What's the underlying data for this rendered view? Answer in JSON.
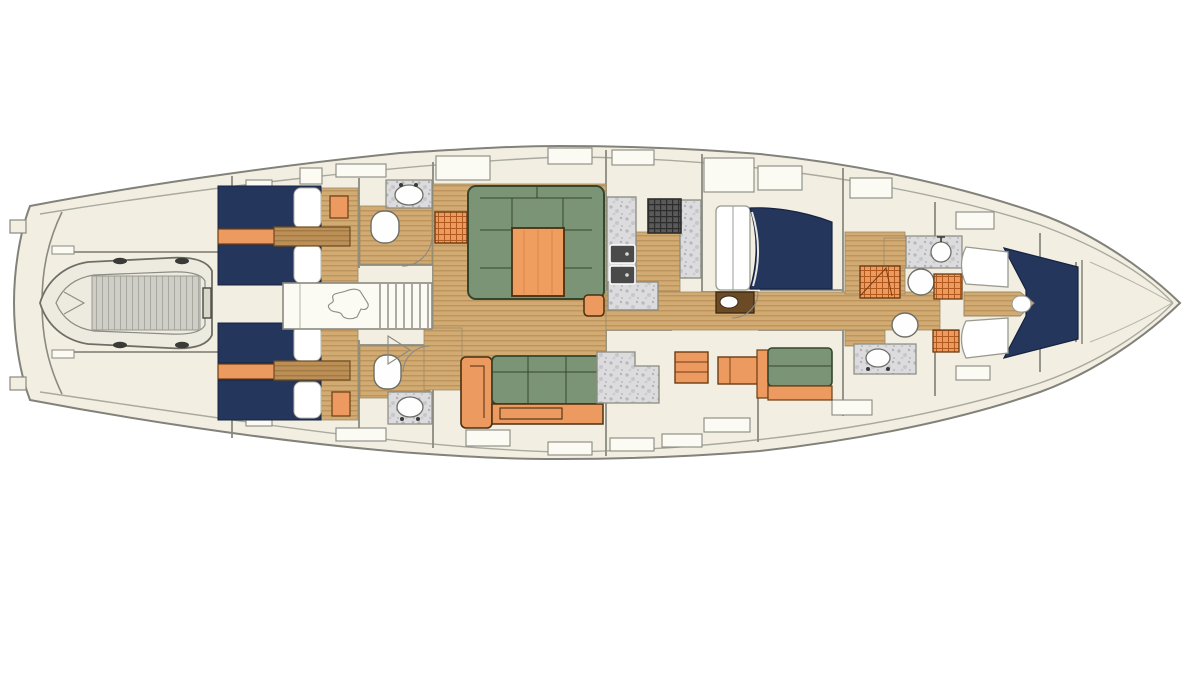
{
  "meta": {
    "title": "Sailing yacht interior deck plan (top-down layout)",
    "diagram_type": "yacht-deck-plan",
    "orientation": {
      "bow": "right",
      "stern": "left",
      "port": "top",
      "starboard": "bottom"
    }
  },
  "colors": {
    "canvas": "#ffffff",
    "hull_fill": "#f2efe2",
    "hull_outline": "#82827a",
    "inner_line": "#a9a99e",
    "line_gray": "#8a8a80",
    "locker_fill": "#fbfaf3",
    "teak_base": "#d2ab73",
    "teak_line": "#b78d56",
    "teak_dark_base": "#bb8f55",
    "teak_dark_line": "#9a7340",
    "marble_base": "#dcdcde",
    "marble_speck": "#b7b7bc",
    "berth_navy": "#24365c",
    "pillow_white": "#ffffff",
    "sofa_green": "#7b9476",
    "sofa_green_dark": "#35462f",
    "wood_orange": "#ec9a5f",
    "wood_orange_dark": "#6b3c12",
    "grate_line": "#b2591e",
    "grill_dark": "#595959",
    "grill_line": "#2d2d2d",
    "fixture_white": "#fefefe",
    "dinghy_fill": "#edebdf",
    "dinghy_slats": "#cfcec6",
    "table_orange": "#ef9e60"
  },
  "areas": [
    {
      "id": "hull",
      "label": "Yacht hull outline"
    },
    {
      "id": "swim-platform",
      "label": "Stern transom and swim platform"
    },
    {
      "id": "tender-garage",
      "label": "Tender garage"
    },
    {
      "id": "dinghy",
      "label": "Inflatable tender (RIB) stowed in garage"
    },
    {
      "id": "aft-cabin-port",
      "label": "Aft twin guest cabin, port side"
    },
    {
      "id": "aft-cabin-starboard",
      "label": "Aft twin guest cabin, starboard side"
    },
    {
      "id": "aft-head-port",
      "label": "Aft head with toilet and sink, port side"
    },
    {
      "id": "aft-head-starboard",
      "label": "Aft head with toilet and sink, starboard side"
    },
    {
      "id": "companionway",
      "label": "Companionway stairs and engine room hatch"
    },
    {
      "id": "salon-port",
      "label": "Salon U-shaped settee with table, port side"
    },
    {
      "id": "salon-starboard",
      "label": "Salon straight settee with armchair, starboard side"
    },
    {
      "id": "galley",
      "label": "Galley with stove, oven and counters"
    },
    {
      "id": "nav-station",
      "label": "Navigation / counter unit"
    },
    {
      "id": "guest-cabin-port",
      "label": "Midship double berth cabin, port side"
    },
    {
      "id": "guest-cabin-starboard",
      "label": "Midship single berth cabin, starboard side"
    },
    {
      "id": "forward-head-port",
      "label": "Forward head with shower grate, port side"
    },
    {
      "id": "forward-head-starboard",
      "label": "Forward head with shower grate, starboard side"
    },
    {
      "id": "owner-cabin",
      "label": "Forward owner's cabin with V-berth"
    },
    {
      "id": "forepeak",
      "label": "Forepeak / anchor locker"
    }
  ]
}
